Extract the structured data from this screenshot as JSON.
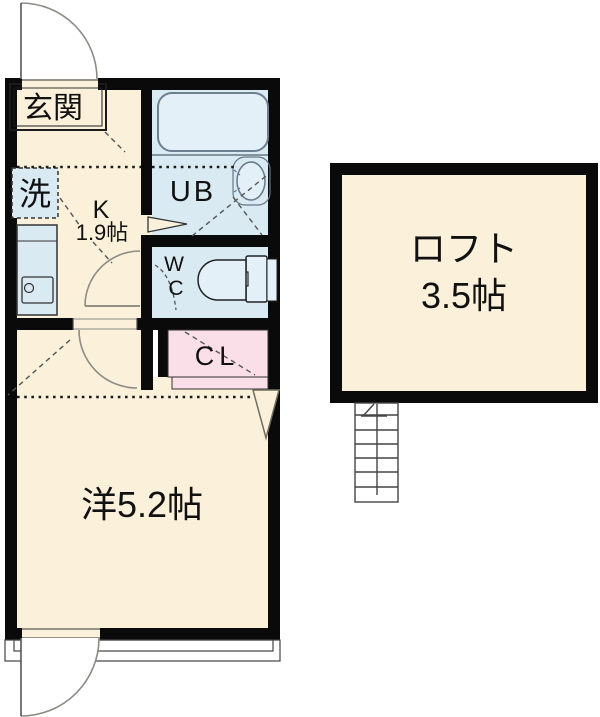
{
  "plan": {
    "type": "apartment-floor-plan",
    "labels": {
      "entrance": "玄関",
      "washer": "洗",
      "kitchen_name": "K",
      "kitchen_size": "1.9帖",
      "unit_bath": "UB",
      "wc_w": "W",
      "wc_c": "C",
      "closet": "CL",
      "western_room": "洋5.2帖",
      "loft_name": "ロフト",
      "loft_size": "3.5帖"
    }
  },
  "colors": {
    "wall": "#0a0a0a",
    "room_beige": "#fbf0da",
    "wet_blue": "#d9eaf3",
    "fixture_blue": "#e4f0f8",
    "closet_pink": "#fadee8",
    "door_arc_gray": "#8c8c85",
    "white": "#ffffff"
  }
}
